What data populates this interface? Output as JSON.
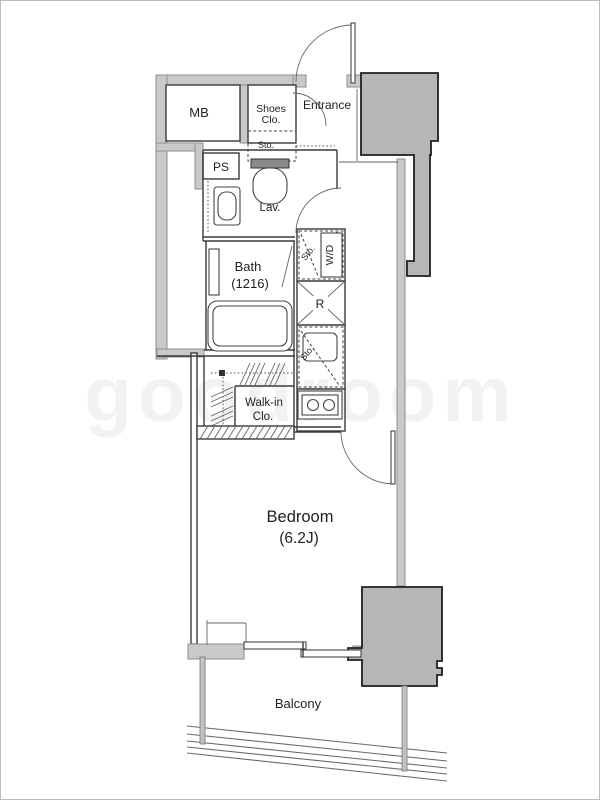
{
  "page": {
    "type": "apartment-floor-plan",
    "unit_layout": "1K"
  },
  "labels": {
    "mb": "MB",
    "ps": "PS",
    "shoes_l1": "Shoes",
    "shoes_l2": "Clo.",
    "entrance": "Entrance",
    "sto_toilet": "Sto.",
    "lav": "Lav.",
    "bath_l1": "Bath",
    "bath_l2": "(1216)",
    "sto_wd": "Sto.",
    "wd": "W/D",
    "fridge": "R",
    "sto_kitchen": "Sto.",
    "wic_l1": "Walk-in",
    "wic_l2": "Clo.",
    "bedroom_l1": "Bedroom",
    "bedroom_l2": "(6.2J)",
    "balcony": "Balcony"
  },
  "watermark": "goodroom",
  "colors": {
    "background": "#ffffff",
    "wall_fill": "#c9c9c9",
    "pillar_fill": "#b6b6b6",
    "line": "#3a3a3a",
    "text": "#222222"
  }
}
